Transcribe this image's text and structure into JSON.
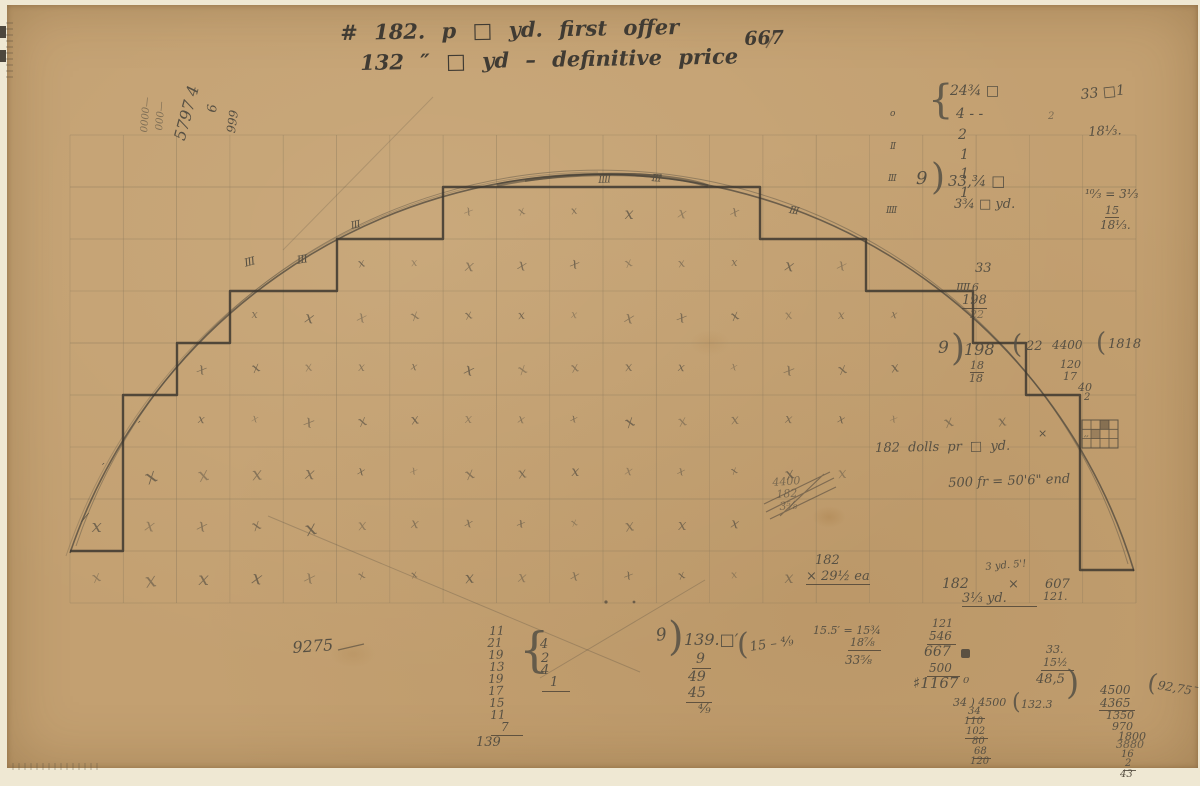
{
  "colors": {
    "paper": "#c3a071",
    "edge": "#efe8d3",
    "pencil": "#575043",
    "pencil_dark": "#403b33"
  },
  "title": {
    "line1": "# 182.  p  □  yd.  first offer",
    "right": "667",
    "line2": "132  ″  □  yd –  definitive price"
  },
  "rotated": {
    "r1": "0000—",
    "r2": "000—",
    "r3": "5797 4",
    "r4": "6",
    "r5": "999"
  },
  "grid": {
    "x0": 70,
    "y0": 135,
    "cols": 20,
    "rows": 9,
    "cell_w": 53.3,
    "cell_h": 52,
    "mark": "x"
  },
  "tallies": {
    "t1": "III",
    "t2": "III",
    "t3": "III",
    "t4": "IIII",
    "t5": "III",
    "t6": "III",
    "c1": "o",
    "c2": "II",
    "c3": "III",
    "c4": "IIII",
    "s1": "′",
    "s2": "′",
    "s3": "⁄",
    "s4": "′′",
    "xe": "×"
  },
  "tr": {
    "brace": "{",
    "l1": "24¾ □",
    "l2": "4 - -",
    "l3": "2",
    "l4": "1",
    "l5": "1",
    "l6": "1",
    "divisor": "9",
    "paren": ")",
    "result": "33,¾ □",
    "result2": "3¾ □ yd.",
    "small2": "2"
  },
  "fr": {
    "l1": "33 □1",
    "l2": "18⅓.",
    "l3": "¹⁰⁄₃ = 3⅓",
    "l4": "15",
    "l5": "18⅓."
  },
  "n198": {
    "l1": "33",
    "l2": "IIII 6",
    "l3": "198",
    "l4": "22",
    "divisor": "9",
    "paren": ")",
    "dividend": "198",
    "r1": "18",
    "r2": "18",
    "p22": "(",
    "c22": "22",
    "c4400": "4400",
    "c120": "120",
    "c17": "17",
    "c40": "40",
    "c2": "2",
    "p1818": "(",
    "c1818": "1818"
  },
  "mid": {
    "dolls": "182 dolls pr □ yd.",
    "fr500": "500 fr = 50'6\" end",
    "x1": "4400",
    "x2": "182",
    "x3": "3⅝"
  },
  "m182": {
    "a1": "182",
    "a2": "× 29½ ea",
    "b1": "3 yd. 5'!",
    "b2": "182",
    "b2x": "×",
    "b3": "3⅓ yd.",
    "c1": "607",
    "c2": "121."
  },
  "sum139": {
    "rows": [
      "11",
      "21",
      "19",
      "13",
      "19",
      "17",
      "15",
      "11",
      "7"
    ],
    "total": "139",
    "brace": "{",
    "d1": "4",
    "d2": "2",
    "d3": "4",
    "d4": "1"
  },
  "n9275": "9275",
  "d139": {
    "divisor": "9",
    "paren": ")",
    "dividend": "139.□′",
    "qparen": "(",
    "quot": "15 – ⁴⁄₉",
    "w1": "9",
    "w2": "49",
    "w3": "45",
    "w4": "⁴⁄₉"
  },
  "n155": {
    "l1": "15.5′ = 15¾",
    "l2": "18⅞",
    "l3": "33⅝"
  },
  "n1167": {
    "l1": "121",
    "l2": "546",
    "l3": "667",
    "l4": "500",
    "l5": "♯1167 ⁰"
  },
  "n485": {
    "l1": "33.",
    "l2": "15½",
    "l3": "48,5",
    "paren": ")",
    "l4": "4500",
    "rparen": "(",
    "res": "92,75¯",
    "c1": "4365",
    "c2": "1350",
    "c3": "970",
    "c4": "1800",
    "c5": "3880",
    "c6": "16",
    "c7": "2",
    "c8": "43"
  },
  "n34": {
    "head": "34 ) 4500",
    "qparen": "(",
    "quot": "132.3",
    "c1": "34",
    "c2": "110",
    "c3": "102",
    "c4": "80",
    "c5": "68",
    "c6": "120"
  }
}
